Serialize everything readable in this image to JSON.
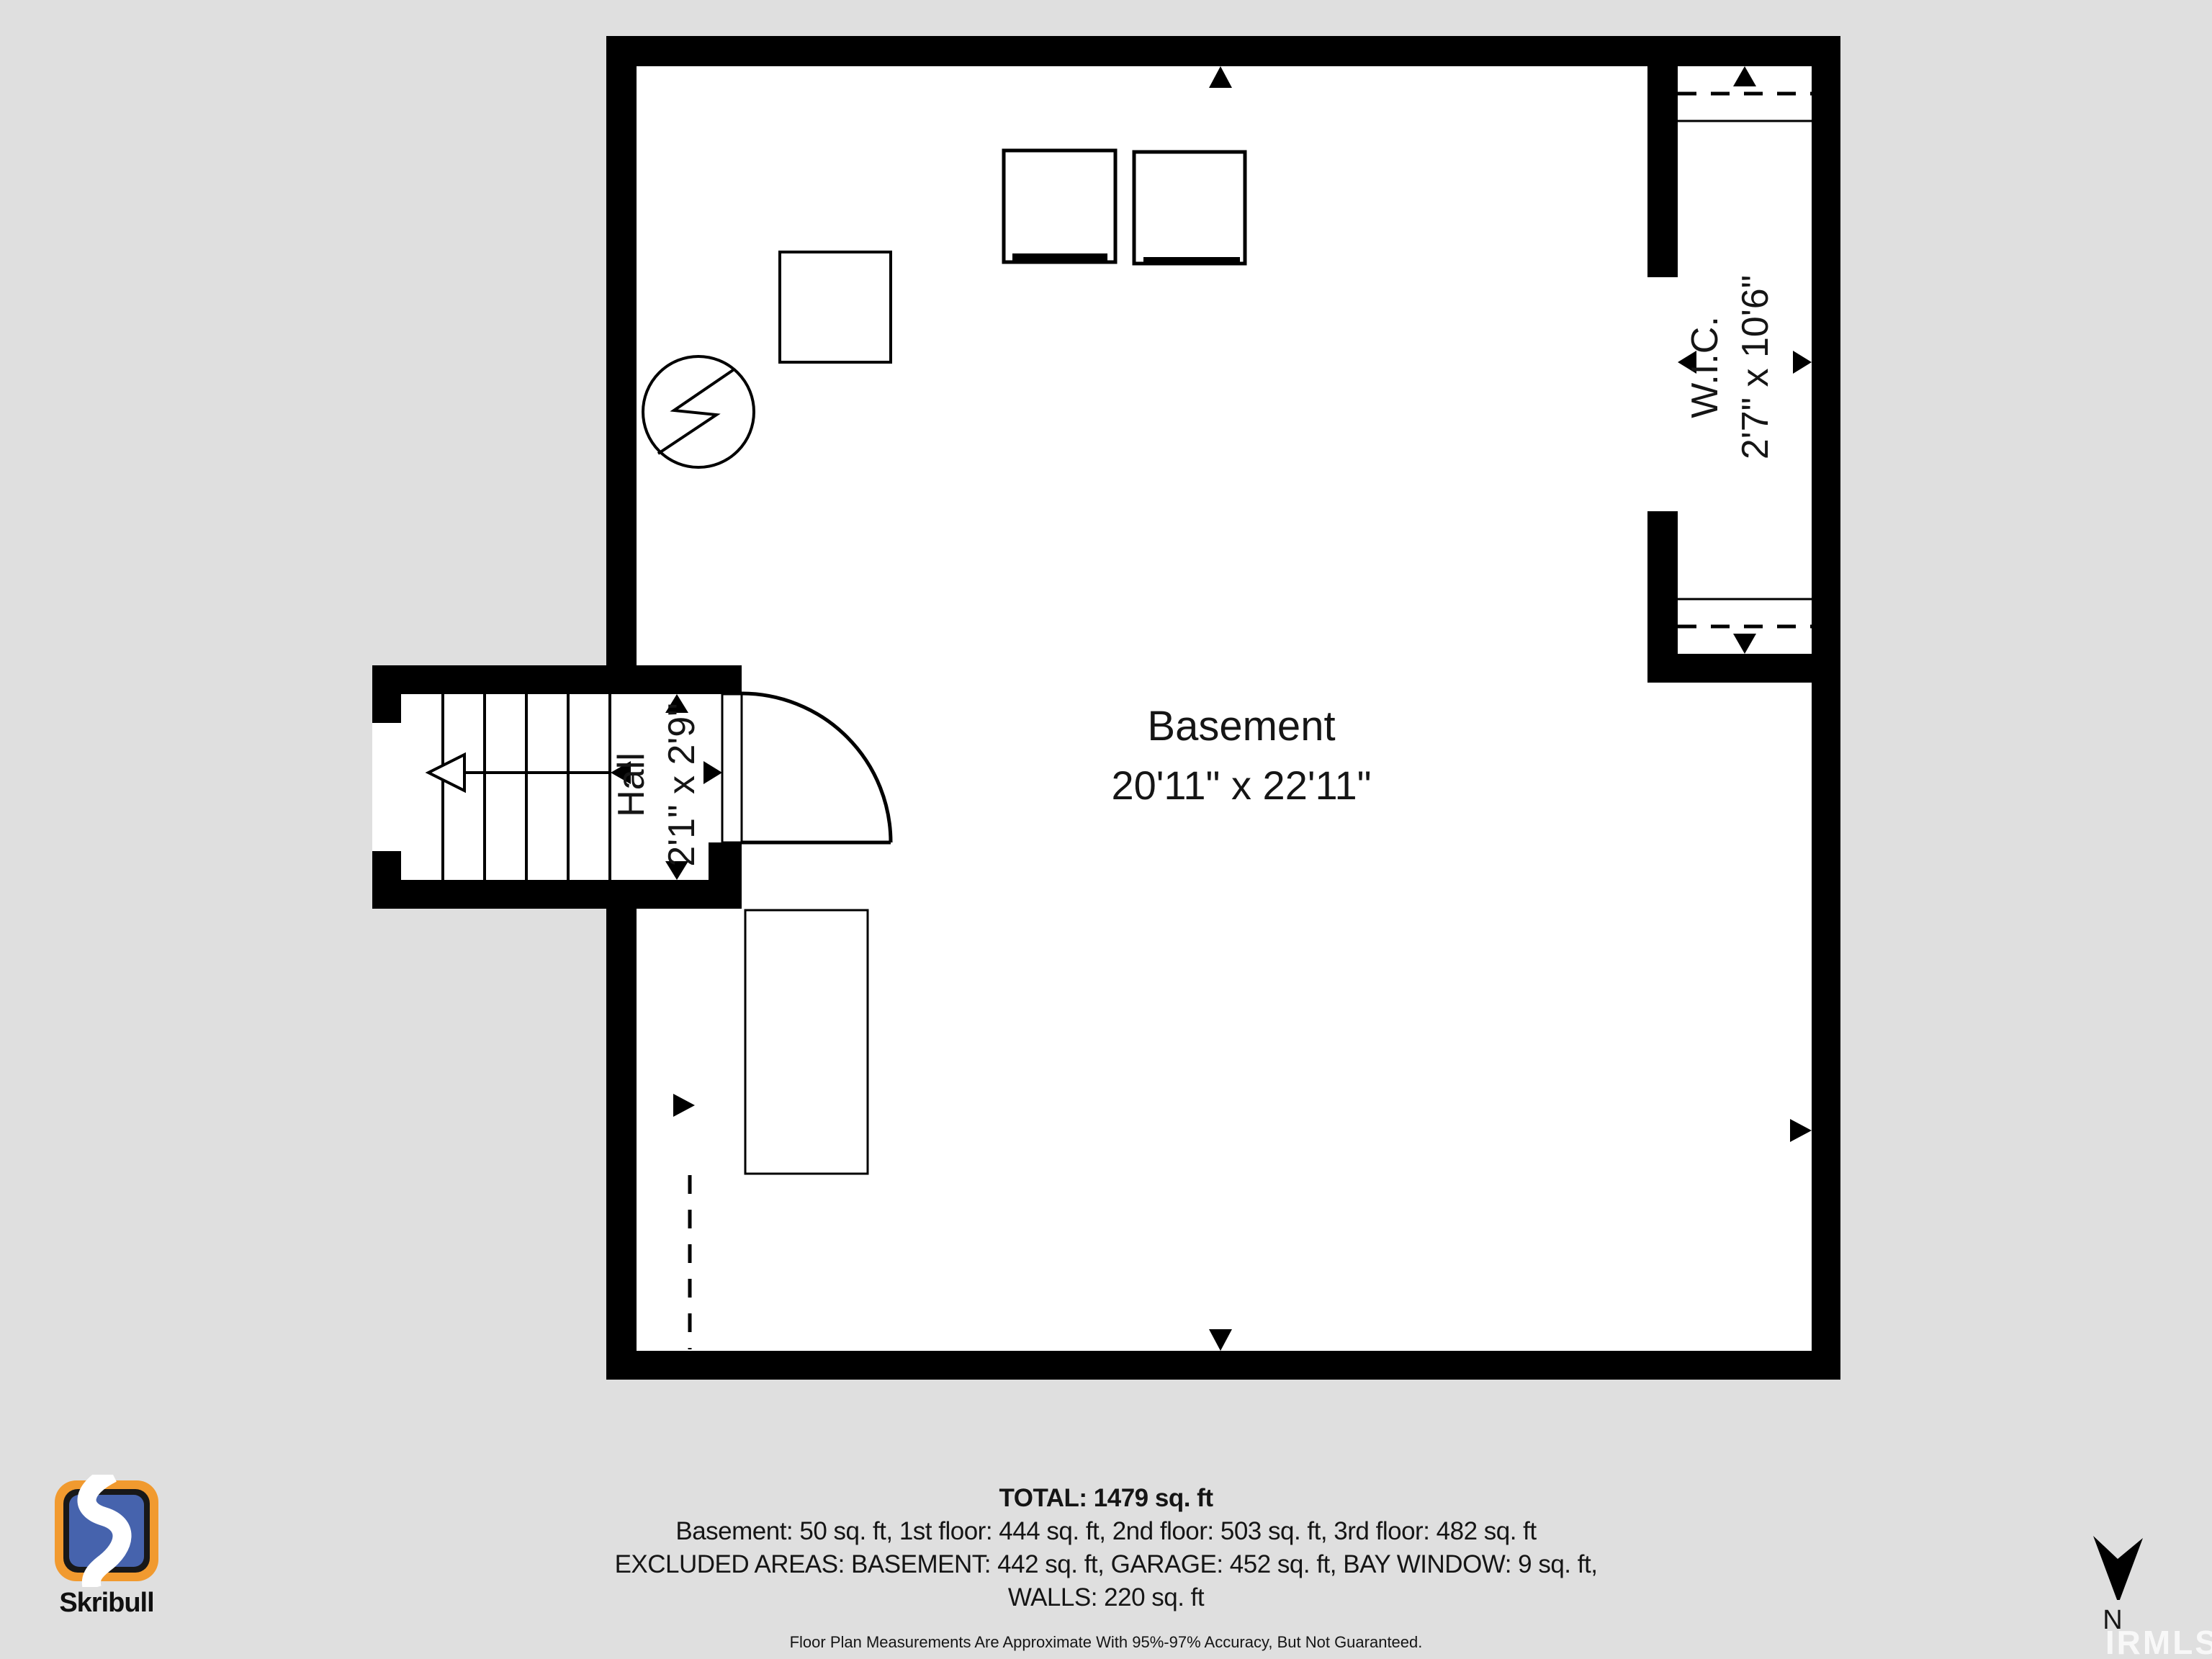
{
  "plan": {
    "rooms": {
      "basement": {
        "name": "Basement",
        "dims": "20'11\" x 22'11\""
      },
      "wic": {
        "name": "W.I.C.",
        "dims": "2'7\" x 10'6\""
      },
      "hall": {
        "name": "Hall",
        "dims": "2'1\" x 2'9\""
      }
    },
    "symbols": [
      "stairs-up-arrow",
      "door-swing",
      "electrical-circle-bolt",
      "washer",
      "dryer",
      "storage-box",
      "closet-rod-dashed"
    ]
  },
  "footer": {
    "total": "TOTAL: 1479 sq. ft",
    "floors": "Basement: 50 sq. ft, 1st floor: 444 sq. ft, 2nd floor: 503 sq. ft, 3rd floor: 482 sq. ft",
    "excluded": "EXCLUDED AREAS: BASEMENT: 442 sq. ft, GARAGE: 452 sq. ft, BAY WINDOW: 9 sq. ft,",
    "walls": "WALLS: 220 sq. ft",
    "disclaimer": "Floor Plan Measurements Are Approximate With 95%-97% Accuracy, But Not Guaranteed."
  },
  "branding": {
    "logo_text": "Skribull"
  },
  "compass": {
    "label": "N"
  },
  "watermark": {
    "text": "IRMLS"
  },
  "colors": {
    "background": "#dfdfdf",
    "walls": "#000000",
    "floor": "#ffffff",
    "logo_orange": "#f19a2f",
    "logo_blue": "#4663ad",
    "watermark": "#ffffff"
  }
}
